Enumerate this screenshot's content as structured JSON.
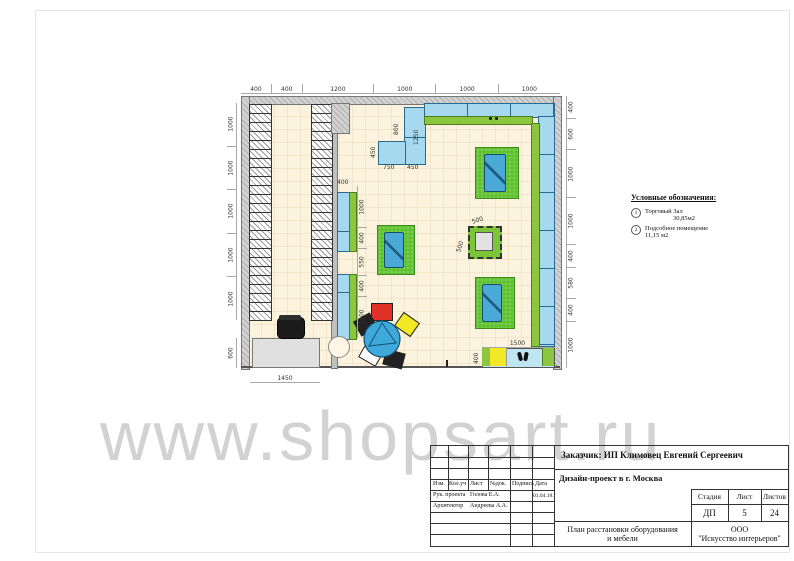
{
  "watermark": "www.shopsart.ru",
  "legend": {
    "title": "Условные обозначения:",
    "items": [
      {
        "num": "1",
        "label": "Торговый Зал",
        "area": "30,85м2"
      },
      {
        "num": "2",
        "label": "Подсобное помещение",
        "area": "11,15 м2"
      }
    ]
  },
  "plan": {
    "dims": {
      "top": [
        "400",
        "400",
        "1200",
        "1000",
        "1000",
        "1000"
      ],
      "left": [
        "1000",
        "1000",
        "1000",
        "1000",
        "1000"
      ],
      "left_bottom": [
        "600"
      ],
      "right": [
        "400",
        "600",
        "1000",
        "1000",
        "400",
        "580",
        "400",
        "1000"
      ],
      "partition_top": "400",
      "partition": [
        "1000",
        "400",
        "550",
        "400",
        "1000"
      ],
      "counter": [
        "1450"
      ],
      "bench_w": [
        "1500"
      ],
      "bench_d": "400",
      "column_w": "500",
      "column_h": "500",
      "cash": {
        "left_v": "800",
        "right_v": "1250",
        "side_v": "450",
        "bottom_l": "750",
        "bottom_r": "450"
      }
    }
  },
  "titleblock": {
    "client": "Заказчик:  ИП Климовец Евгений Сергеевич",
    "project": "Дизайн-проект в г. Москва",
    "grid_headers": [
      "Изм.",
      "Кол.уч",
      "Лист",
      "№док.",
      "Подпись",
      "Дата"
    ],
    "staff": [
      {
        "role": "Рук. проекта",
        "name": "Голова Е.А.",
        "date": "01.04.18."
      },
      {
        "role": "Архитектор",
        "name": "Андреева А.А.",
        "date": ""
      }
    ],
    "stage_label": "Стадия",
    "sheet_label": "Лист",
    "sheets_label": "Листов",
    "stage": "ДП",
    "sheet": "5",
    "sheets": "24",
    "drawing_title_1": "План расстановки оборудования",
    "drawing_title_2": "и мебели",
    "company_1": "ООО",
    "company_2": "\"Искусство интерьеров\""
  },
  "colors": {
    "display_blue": "#a6d9f0",
    "shelf_green": "#8cc63e",
    "island_green": "#62c332",
    "table_blue": "#3fa9dc",
    "chair_red": "#e03228",
    "chair_yellow": "#f2e826"
  }
}
